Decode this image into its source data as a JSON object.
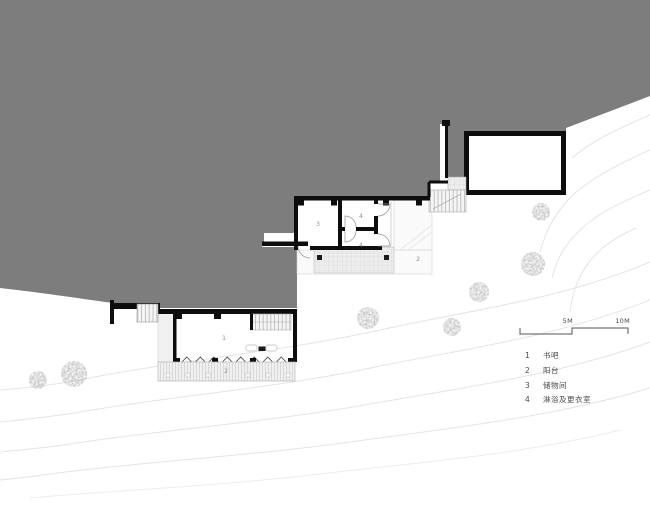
{
  "plan": {
    "room_labels": {
      "book_bar": "1",
      "deck_balcony": "2",
      "upper_balcony": "2",
      "storage": "3",
      "shower_upper": "4",
      "shower_lower": "4"
    }
  },
  "scale_bar": {
    "mid": "5M",
    "end": "10M"
  },
  "legend": {
    "items": [
      {
        "num": "1",
        "label": "书吧"
      },
      {
        "num": "2",
        "label": "阳台"
      },
      {
        "num": "3",
        "label": "储物间"
      },
      {
        "num": "4",
        "label": "淋浴及更衣室"
      }
    ]
  },
  "colors": {
    "terrain": "#7d7d7d",
    "walls": "#111111",
    "contours": "#e5e5e5",
    "trees": "#a8a8a8"
  }
}
